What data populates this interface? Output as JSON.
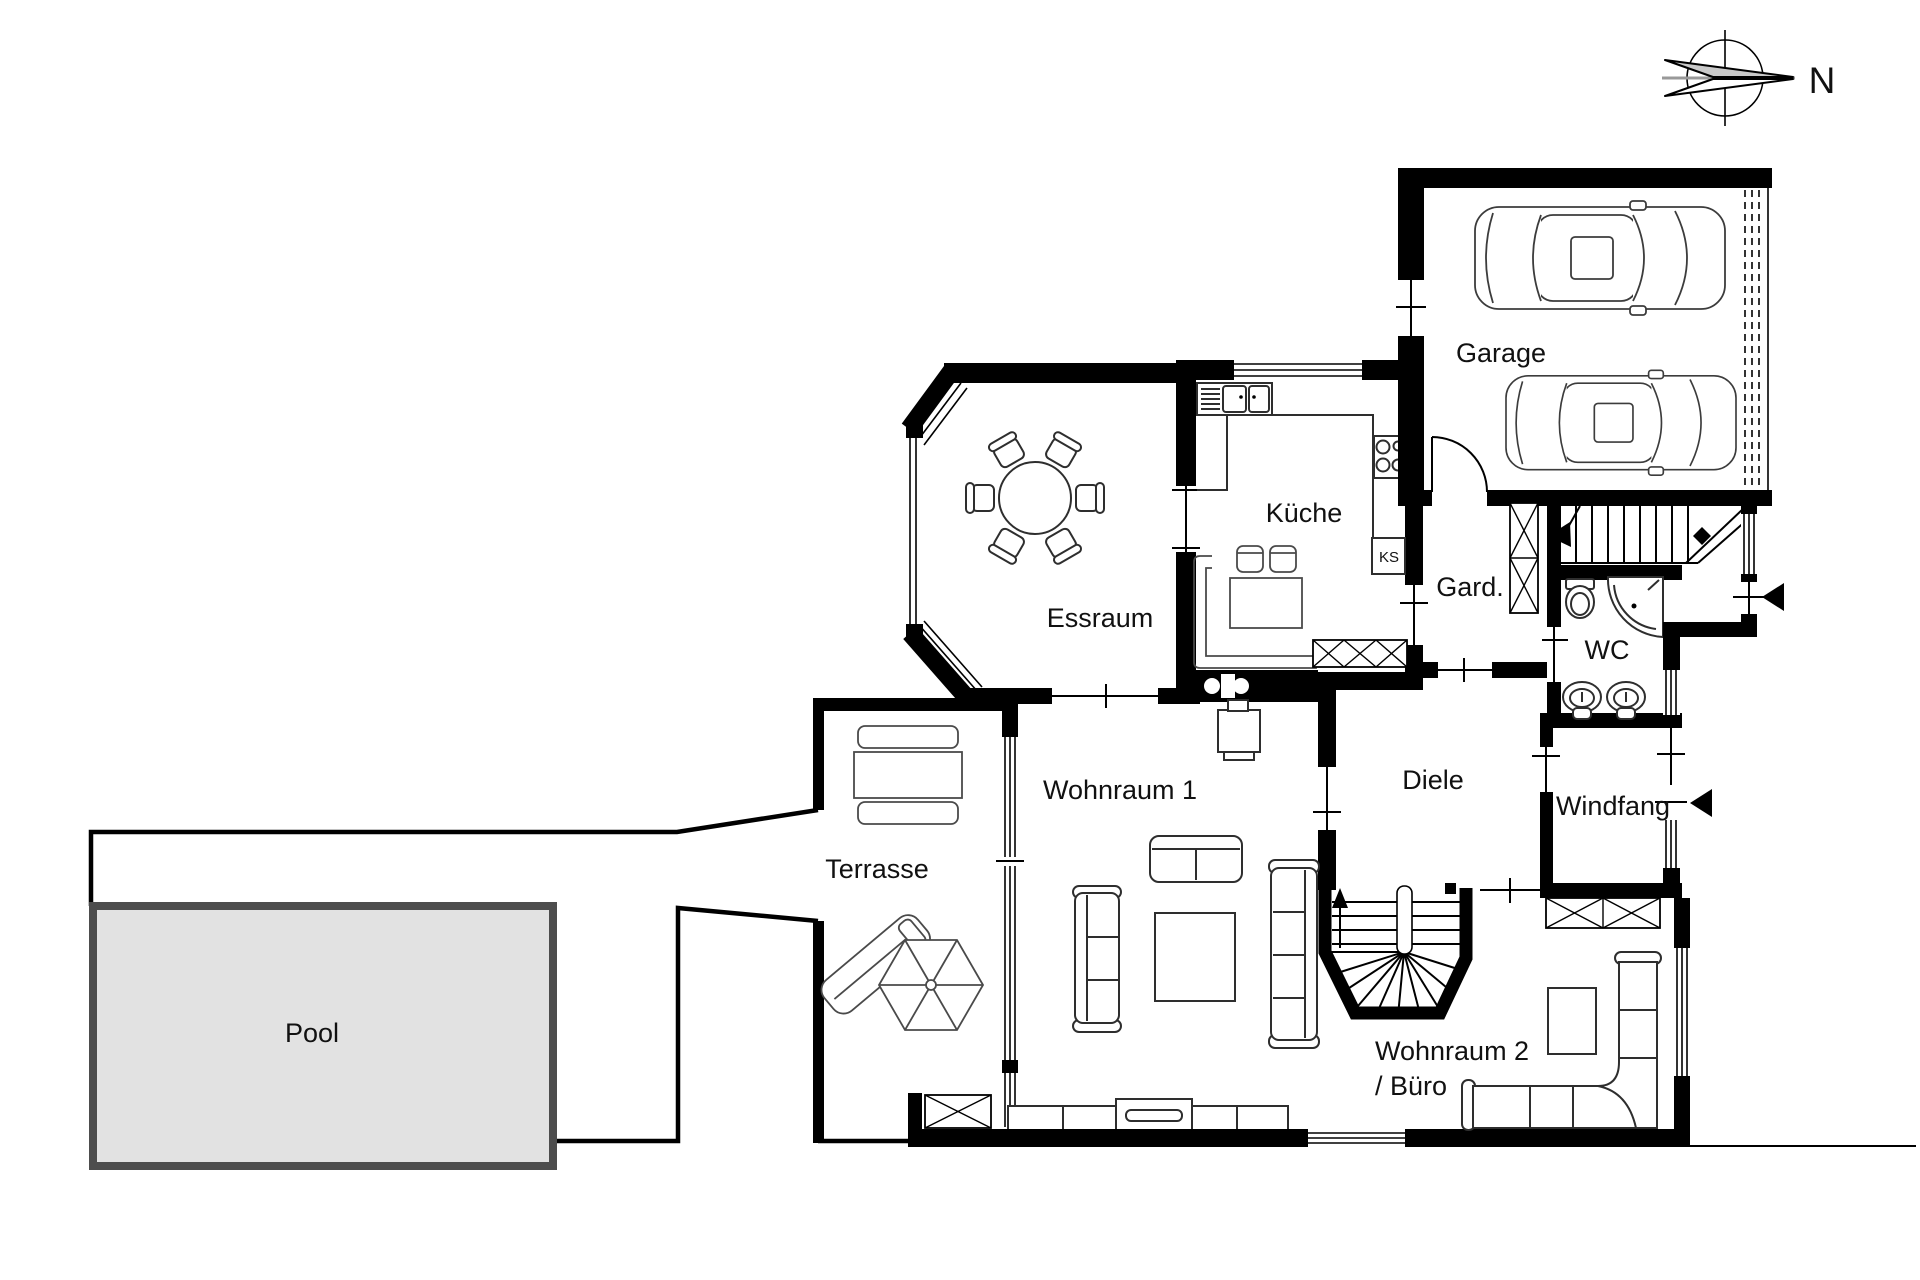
{
  "labels": {
    "garage": "Garage",
    "kueche": "Küche",
    "ks": "KS",
    "gard": "Gard.",
    "wc": "WC",
    "essraum": "Essraum",
    "wohnraum1": "Wohnraum 1",
    "diele": "Diele",
    "windfang": "Windfang",
    "terrasse": "Terrasse",
    "pool": "Pool",
    "wohnraum2_line1": "Wohnraum 2",
    "wohnraum2_line2": "/ Büro",
    "compass_north": "N"
  },
  "colors": {
    "wall": "#000000",
    "pool_fill": "#e2e2e2",
    "pool_border": "#4d4d4d",
    "compass_gray": "#c9c9c9",
    "background": "#ffffff"
  }
}
